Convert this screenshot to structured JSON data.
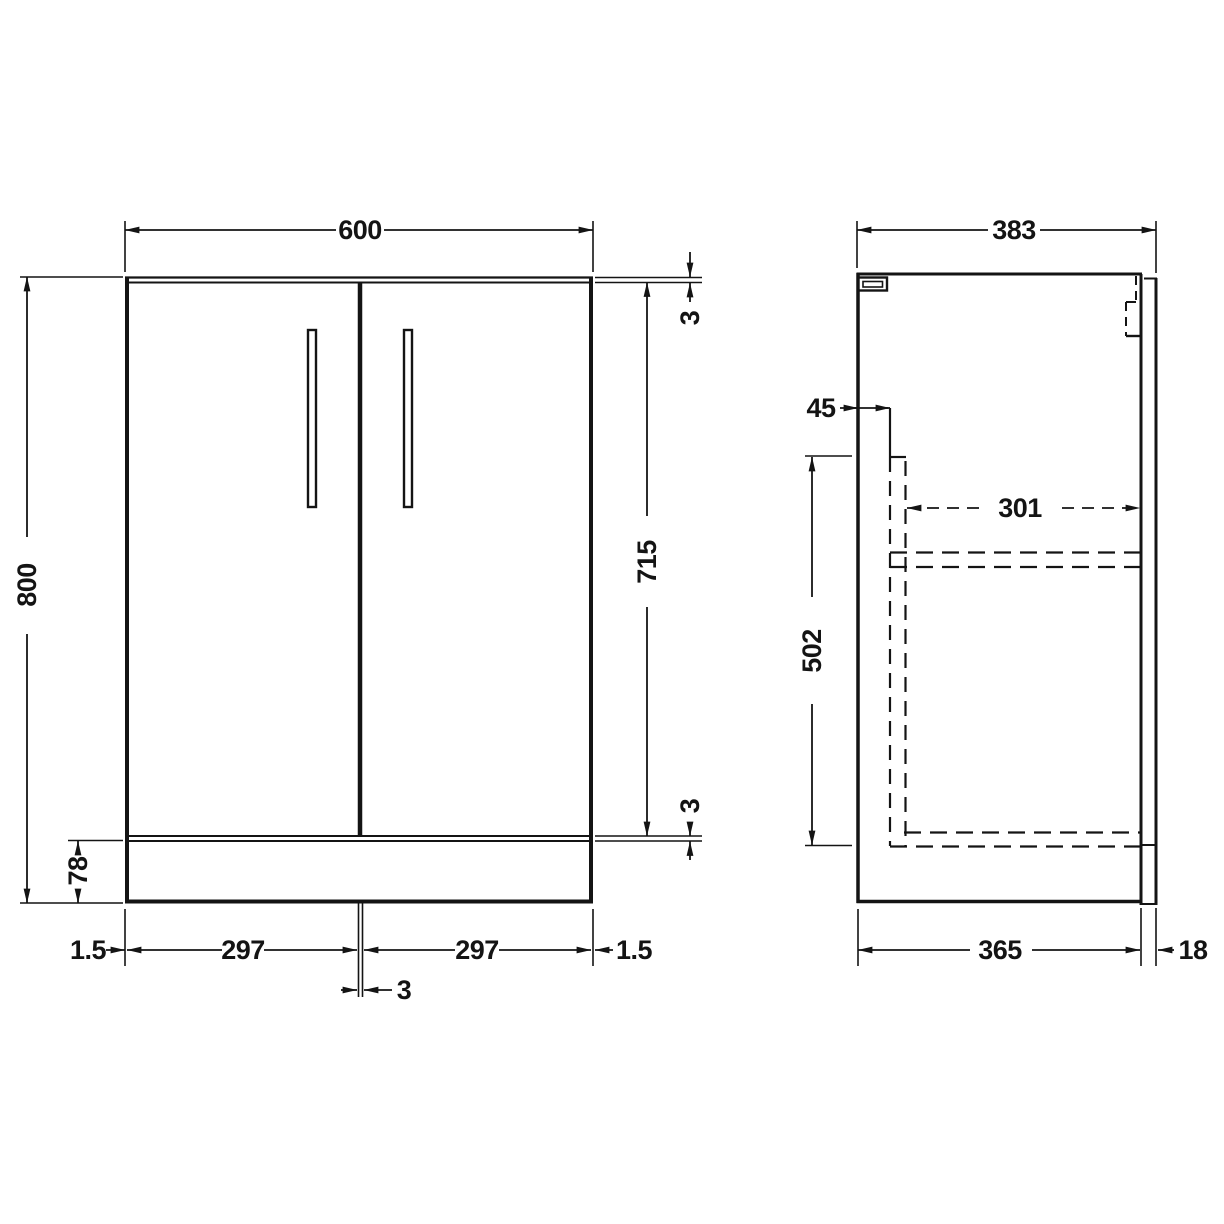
{
  "drawing": {
    "front": {
      "overall_width": "600",
      "overall_height": "800",
      "door_height": "715",
      "top_gap": "3",
      "bottom_gap": "3",
      "plinth_height": "78",
      "left_inset": "1.5",
      "left_door_width": "297",
      "right_door_width": "297",
      "right_inset": "1.5",
      "center_gap": "3"
    },
    "side": {
      "overall_depth": "383",
      "front_offset": "45",
      "internal_depth": "301",
      "internal_height": "502",
      "carcass_depth": "365",
      "back_panel_thickness": "18"
    },
    "style": {
      "line_color": "#141414",
      "background": "#ffffff"
    }
  }
}
